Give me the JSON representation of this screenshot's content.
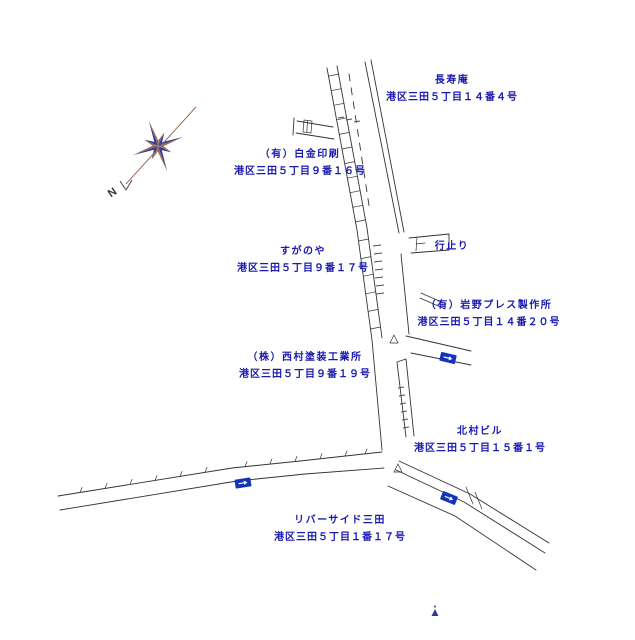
{
  "map": {
    "compass": {
      "letter": "N"
    },
    "labels": [
      {
        "name": "長寿庵",
        "address": "港区三田５丁目１４番４号"
      },
      {
        "name": "（有）白金印刷",
        "address": "港区三田５丁目９番１６号"
      },
      {
        "name": "すがのや",
        "address": "港区三田５丁目９番１７号"
      },
      {
        "name": "行止り",
        "address": ""
      },
      {
        "name": "（有）岩野プレス製作所",
        "address": "港区三田５丁目１４番２０号"
      },
      {
        "name": "（株）西村塗装工業所",
        "address": "港区三田５丁目９番１９号"
      },
      {
        "name": "北村ビル",
        "address": "港区三田５丁目１５番１号"
      },
      {
        "name": "リバーサイド三田",
        "address": "港区三田５丁目１番１７号"
      }
    ],
    "colors": {
      "label_text": "#1a1ab0",
      "road_line": "#333333",
      "tiny_text_marks": "#4a4a6e",
      "compass_blue": "#2a35a0",
      "compass_brown": "#9a6a52",
      "one_way_sign": "#1434b8",
      "marker_blue": "#2a3a9a"
    }
  }
}
